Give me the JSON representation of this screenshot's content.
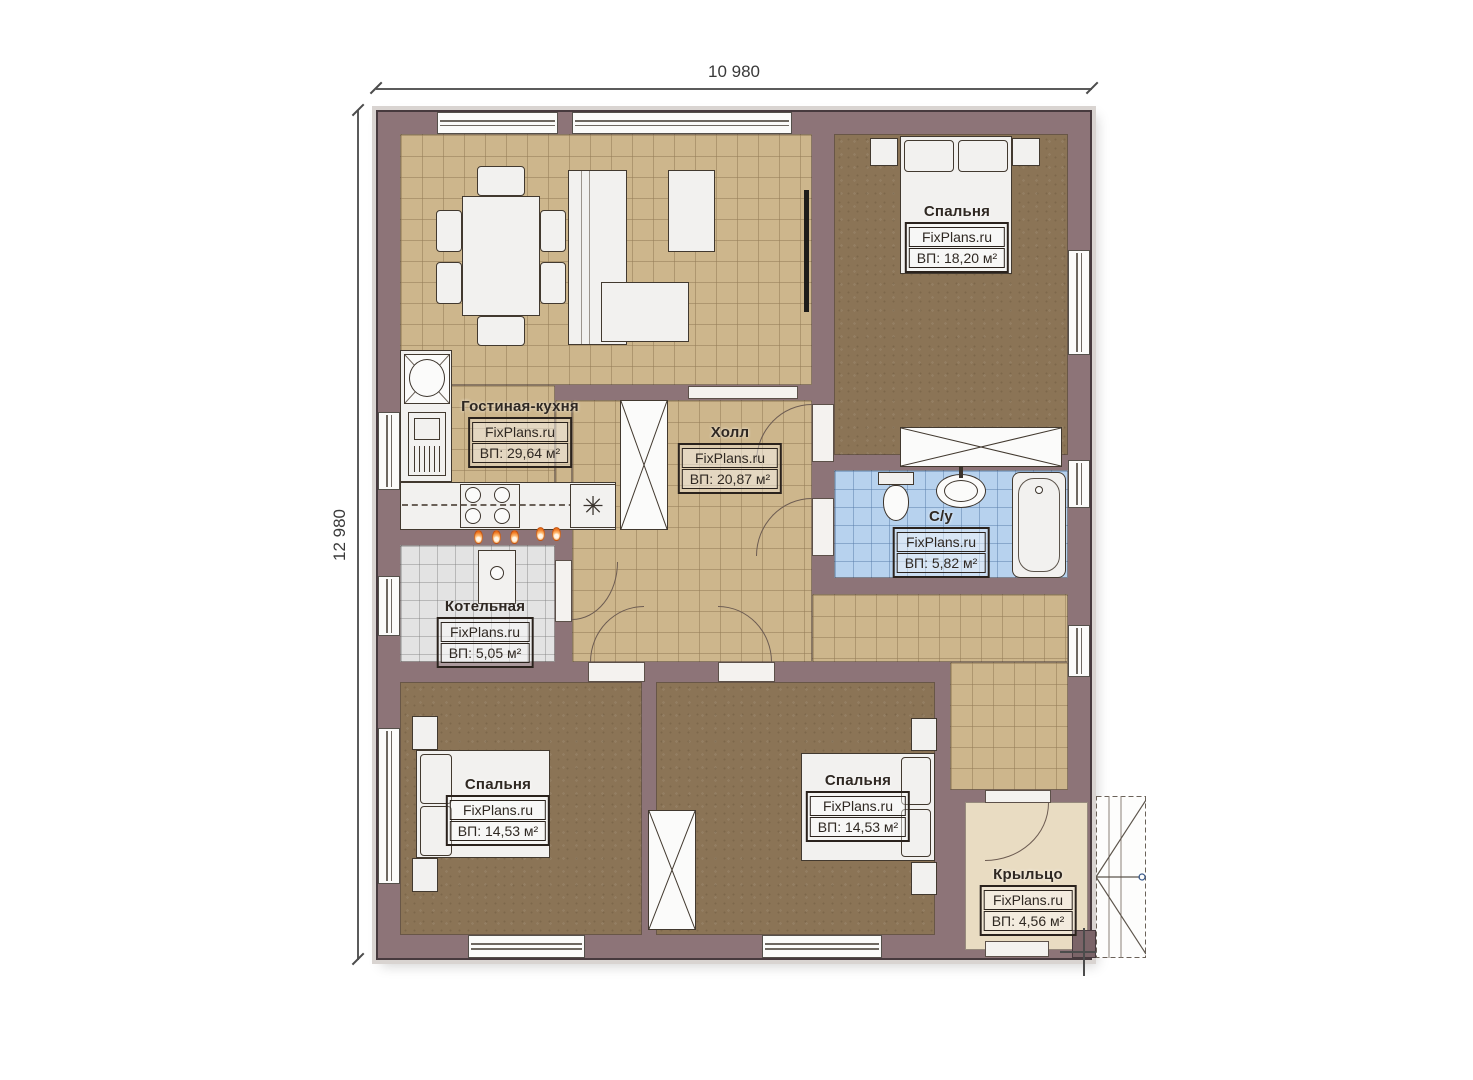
{
  "dims": {
    "width": "10 980",
    "height": "12 980"
  },
  "watermark": "FixPlans.ru",
  "rooms": [
    {
      "id": "living",
      "name": "Гостиная-кухня",
      "brand": "FixPlans.ru",
      "area": "ВП: 29,64 м²"
    },
    {
      "id": "hall",
      "name": "Холл",
      "brand": "FixPlans.ru",
      "area": "ВП: 20,87 м²"
    },
    {
      "id": "bedroom1",
      "name": "Спальня",
      "brand": "FixPlans.ru",
      "area": "ВП: 18,20 м²"
    },
    {
      "id": "bathroom",
      "name": "С/у",
      "brand": "FixPlans.ru",
      "area": "ВП: 5,82 м²"
    },
    {
      "id": "boiler",
      "name": "Котельная",
      "brand": "FixPlans.ru",
      "area": "ВП: 5,05 м²"
    },
    {
      "id": "bedroom2",
      "name": "Спальня",
      "brand": "FixPlans.ru",
      "area": "ВП: 14,53 м²"
    },
    {
      "id": "bedroom3",
      "name": "Спальня",
      "brand": "FixPlans.ru",
      "area": "ВП: 14,53 м²"
    },
    {
      "id": "porch",
      "name": "Крыльцо",
      "brand": "FixPlans.ru",
      "area": "ВП: 4,56 м²"
    }
  ],
  "icons": {
    "dishwasher": "✳"
  },
  "colors": {
    "wall": "#8d7478",
    "tile_floor": "#cdb68c",
    "bedroom_floor": "#8b7456",
    "bathroom_floor": "#b7d2ee",
    "boiler_floor": "#e3e3e3",
    "porch_floor": "#e9dcc2",
    "flame_accent": "#f07a22"
  }
}
